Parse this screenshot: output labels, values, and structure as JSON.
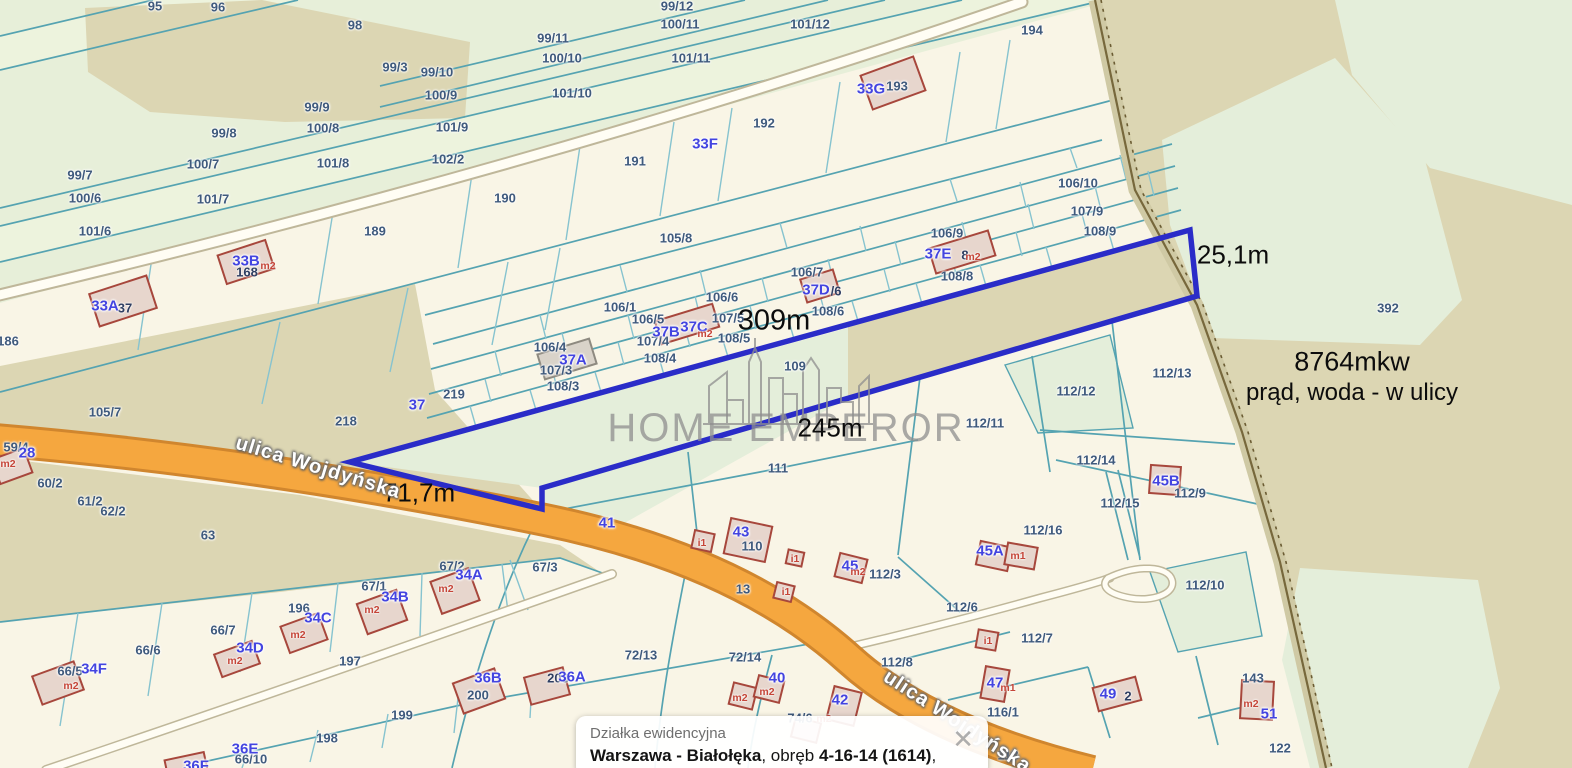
{
  "map": {
    "colors": {
      "base": "#e7efd9",
      "strip_pale": "#edf3dd",
      "cream": "#f9f5e6",
      "tan": "#dcd6b3",
      "green_patch": "#e4eeda",
      "teal": "#55a3b1",
      "cyan": "#86c3cf",
      "orange": "#f5a73f",
      "orange_edge": "#d0862e",
      "road_white": "#fffdf4",
      "road_case": "#bfb79a",
      "plot_blue": "#2a2cc8",
      "building_fill": "#e7d6cd",
      "building_edge": "#a7473c",
      "boundary_band": "#cfc9a4",
      "boundary_line": "#77683c",
      "label_parcel": "#3f5a7d",
      "label_building": "#4344e0",
      "label_unit": "#c54538",
      "measure_black": "#0c0c0c",
      "watermark_gray": "#8f8f8f"
    },
    "watermark": {
      "brand": "HOME EMPEROR"
    },
    "info_box": {
      "title": "Działka ewidencyjna",
      "parts": [
        [
          "Warszawa - Białołęka",
          1
        ],
        [
          ", obręb ",
          0
        ],
        [
          "4-16-14 (1614)",
          1
        ],
        [
          ", numer dz.",
          0
        ],
        [
          "109",
          1
        ]
      ],
      "close": "✕"
    },
    "notes": [
      [
        "8764mkw",
        1352,
        362,
        27
      ],
      [
        "prąd, woda - w ulicy",
        1352,
        393,
        24
      ]
    ],
    "measurements": [
      [
        "25,1m",
        1233,
        255,
        26
      ],
      [
        "309m",
        774,
        321,
        29
      ],
      [
        "245m",
        830,
        428,
        26
      ],
      [
        "71,7m",
        419,
        493,
        26
      ]
    ],
    "street_labels": [
      [
        "ulica Wojdyńska",
        318,
        468,
        20,
        17
      ],
      [
        "ulica Wojdyńska",
        957,
        722,
        20,
        33
      ]
    ],
    "parcel_labels": [
      [
        "95",
        155,
        6
      ],
      [
        "96",
        218,
        7
      ],
      [
        "98",
        355,
        25
      ],
      [
        "99/12",
        677,
        6
      ],
      [
        "100/11",
        680,
        24
      ],
      [
        "101/12",
        810,
        24
      ],
      [
        "99/11",
        553,
        38
      ],
      [
        "100/10",
        562,
        58
      ],
      [
        "101/11",
        691,
        58
      ],
      [
        "101/10",
        572,
        93
      ],
      [
        "194",
        1032,
        30
      ],
      [
        "99/3",
        395,
        67
      ],
      [
        "99/10",
        437,
        72
      ],
      [
        "100/9",
        441,
        95
      ],
      [
        "99/9",
        317,
        107
      ],
      [
        "100/8",
        323,
        128
      ],
      [
        "101/9",
        452,
        127
      ],
      [
        "99/8",
        224,
        133
      ],
      [
        "100/7",
        203,
        164
      ],
      [
        "101/8",
        333,
        163
      ],
      [
        "102/2",
        448,
        159
      ],
      [
        "99/7",
        80,
        175
      ],
      [
        "100/6",
        85,
        198
      ],
      [
        "101/7",
        213,
        199
      ],
      [
        "101/6",
        95,
        231
      ],
      [
        "189",
        375,
        231
      ],
      [
        "190",
        505,
        198
      ],
      [
        "191",
        635,
        161
      ],
      [
        "192",
        764,
        123
      ],
      [
        "193",
        897,
        86
      ],
      [
        "186",
        8,
        341
      ],
      [
        "106/10",
        1078,
        183
      ],
      [
        "107/9",
        1087,
        211
      ],
      [
        "108/9",
        1100,
        231
      ],
      [
        "106/9",
        947,
        233
      ],
      [
        "105/8",
        676,
        238
      ],
      [
        "108/8",
        957,
        276
      ],
      [
        "106/7",
        807,
        272
      ],
      [
        "106/6",
        722,
        297
      ],
      [
        "108/6",
        828,
        311
      ],
      [
        "106/1",
        620,
        307
      ],
      [
        "106/5",
        648,
        319
      ],
      [
        "107/5",
        728,
        318
      ],
      [
        "107/4",
        653,
        341
      ],
      [
        "108/5",
        734,
        338
      ],
      [
        "108/4",
        660,
        358
      ],
      [
        "106/4",
        550,
        347
      ],
      [
        "107/3",
        556,
        370
      ],
      [
        "108/3",
        563,
        386
      ],
      [
        "219",
        454,
        394
      ],
      [
        "218",
        346,
        421
      ],
      [
        "105/7",
        105,
        412
      ],
      [
        "63",
        208,
        535
      ],
      [
        "60/2",
        50,
        483
      ],
      [
        "61/2",
        90,
        501
      ],
      [
        "62/2",
        113,
        511
      ],
      [
        "59/4",
        16,
        447
      ],
      [
        "109",
        795,
        366
      ],
      [
        "111",
        778,
        468
      ],
      [
        "112/12",
        1076,
        391
      ],
      [
        "112/13",
        1172,
        373
      ],
      [
        "112/11",
        985,
        423
      ],
      [
        "112/14",
        1096,
        460
      ],
      [
        "112/9",
        1190,
        493
      ],
      [
        "112/15",
        1120,
        503
      ],
      [
        "112/16",
        1043,
        530
      ],
      [
        "392",
        1388,
        308
      ],
      [
        "112/3",
        885,
        574
      ],
      [
        "112/6",
        962,
        607
      ],
      [
        "112/8",
        897,
        662
      ],
      [
        "112/7",
        1037,
        638
      ],
      [
        "72/13",
        641,
        655
      ],
      [
        "72/14",
        745,
        657
      ],
      [
        "112/10",
        1205,
        585
      ],
      [
        "116/1",
        1003,
        712
      ],
      [
        "118",
        1008,
        755
      ],
      [
        "122",
        1280,
        748
      ],
      [
        "143",
        1253,
        678
      ],
      [
        "196",
        299,
        608
      ],
      [
        "197",
        350,
        661
      ],
      [
        "198",
        327,
        738
      ],
      [
        "199",
        402,
        715
      ],
      [
        "200",
        478,
        695
      ],
      [
        "66/7",
        223,
        630
      ],
      [
        "66/6",
        148,
        650
      ],
      [
        "66/5",
        70,
        671
      ],
      [
        "66/10",
        251,
        759
      ],
      [
        "67/1",
        374,
        586
      ],
      [
        "67/2",
        452,
        566
      ],
      [
        "67/3",
        545,
        567
      ],
      [
        "74/6",
        800,
        718
      ],
      [
        "110",
        752,
        546
      ],
      [
        "13",
        743,
        589
      ]
    ],
    "small_labels": [
      [
        "37",
        125,
        308
      ],
      [
        "168",
        247,
        272
      ],
      [
        "8",
        965,
        255
      ],
      [
        "/6",
        836,
        291
      ],
      [
        "2",
        1128,
        696
      ],
      [
        "203",
        558,
        678
      ]
    ],
    "building_labels": [
      [
        "33G",
        871,
        89
      ],
      [
        "33F",
        705,
        144
      ],
      [
        "33B",
        246,
        261
      ],
      [
        "33A",
        105,
        306
      ],
      [
        "37A",
        573,
        360
      ],
      [
        "37B",
        666,
        332
      ],
      [
        "37C",
        694,
        327
      ],
      [
        "37D",
        816,
        290
      ],
      [
        "37E",
        938,
        254
      ],
      [
        "37",
        417,
        405
      ],
      [
        "28",
        27,
        453
      ],
      [
        "41",
        607,
        523
      ],
      [
        "43",
        741,
        532
      ],
      [
        "45",
        850,
        566
      ],
      [
        "45A",
        990,
        551
      ],
      [
        "45B",
        1166,
        481
      ],
      [
        "47",
        995,
        683
      ],
      [
        "49",
        1108,
        694
      ],
      [
        "51",
        1269,
        714
      ],
      [
        "34A",
        469,
        575
      ],
      [
        "34B",
        395,
        597
      ],
      [
        "34C",
        318,
        618
      ],
      [
        "34D",
        250,
        648
      ],
      [
        "34F",
        94,
        669
      ],
      [
        "36B",
        488,
        678
      ],
      [
        "36A",
        572,
        677
      ],
      [
        "36E",
        245,
        749
      ],
      [
        "36F",
        196,
        766
      ],
      [
        "40",
        777,
        678
      ],
      [
        "42",
        840,
        700
      ]
    ],
    "unit_labels": [
      [
        "m2",
        973,
        257
      ],
      [
        "m2",
        705,
        334
      ],
      [
        "m2",
        268,
        266
      ],
      [
        "m2",
        446,
        589
      ],
      [
        "m2",
        372,
        610
      ],
      [
        "m2",
        298,
        635
      ],
      [
        "m2",
        235,
        661
      ],
      [
        "m2",
        71,
        686
      ],
      [
        "m2",
        8,
        464
      ],
      [
        "m2",
        740,
        698
      ],
      [
        "m2",
        767,
        692
      ],
      [
        "m2",
        824,
        719
      ],
      [
        "m2",
        858,
        572
      ],
      [
        "m2",
        1251,
        704
      ],
      [
        "m1",
        1008,
        688
      ],
      [
        "m1",
        1018,
        556
      ],
      [
        "i1",
        702,
        543
      ],
      [
        "i1",
        795,
        559
      ],
      [
        "i1",
        786,
        592
      ],
      [
        "i1",
        988,
        641
      ]
    ],
    "buildings": [
      [
        893,
        83,
        56,
        36,
        -20
      ],
      [
        246,
        262,
        50,
        30,
        -18
      ],
      [
        123,
        301,
        60,
        34,
        -18
      ],
      [
        567,
        359,
        54,
        26,
        -17,
        1
      ],
      [
        687,
        324,
        60,
        24,
        -17
      ],
      [
        820,
        286,
        34,
        24,
        -17
      ],
      [
        962,
        252,
        62,
        26,
        -17
      ],
      [
        455,
        591,
        40,
        34,
        -20
      ],
      [
        382,
        612,
        42,
        32,
        -20
      ],
      [
        304,
        633,
        40,
        28,
        -20
      ],
      [
        237,
        659,
        40,
        24,
        -20
      ],
      [
        58,
        683,
        44,
        30,
        -20
      ],
      [
        12,
        466,
        34,
        26,
        -20
      ],
      [
        479,
        691,
        44,
        32,
        -20
      ],
      [
        547,
        686,
        40,
        28,
        -15
      ],
      [
        186,
        765,
        40,
        18,
        -12
      ],
      [
        748,
        540,
        42,
        36,
        12
      ],
      [
        703,
        541,
        20,
        18,
        12
      ],
      [
        795,
        558,
        16,
        14,
        12
      ],
      [
        784,
        592,
        18,
        16,
        14
      ],
      [
        851,
        568,
        28,
        24,
        14
      ],
      [
        994,
        556,
        32,
        24,
        12
      ],
      [
        743,
        696,
        24,
        22,
        14
      ],
      [
        769,
        689,
        26,
        22,
        14
      ],
      [
        844,
        706,
        28,
        34,
        14
      ],
      [
        806,
        730,
        26,
        20,
        14
      ],
      [
        995,
        684,
        24,
        32,
        10
      ],
      [
        987,
        640,
        20,
        18,
        10
      ],
      [
        1165,
        480,
        30,
        28,
        4
      ],
      [
        1021,
        556,
        30,
        22,
        10
      ],
      [
        1117,
        694,
        44,
        24,
        -15
      ],
      [
        1257,
        700,
        32,
        38,
        3
      ]
    ]
  }
}
